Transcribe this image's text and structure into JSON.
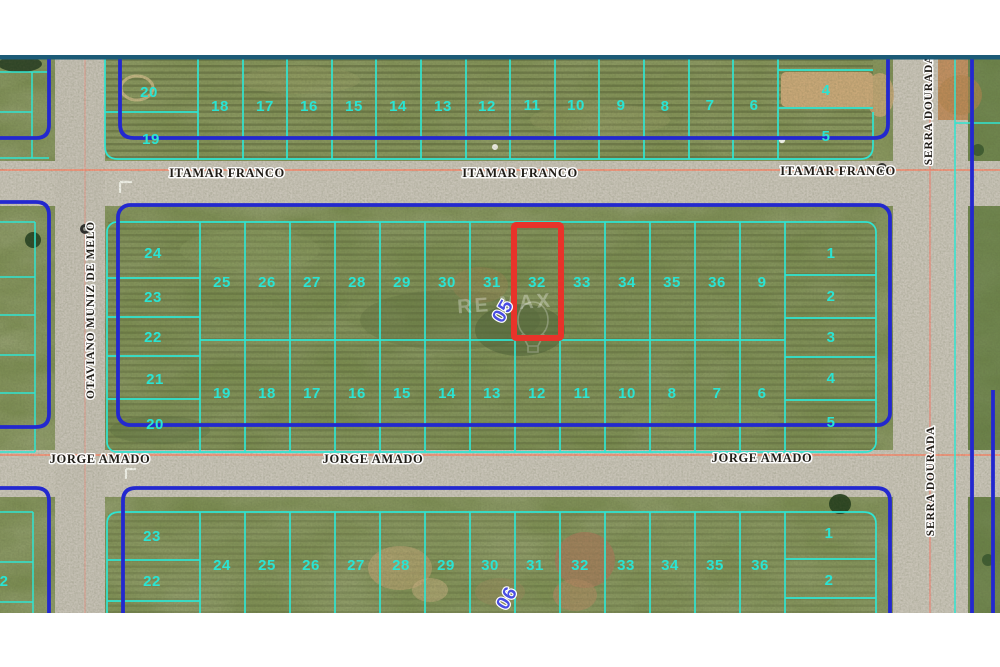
{
  "map": {
    "title": "Aerial lot map with highlighted lot 32",
    "streets": {
      "itamar_franco": {
        "name": "ITAMAR FRANCO"
      },
      "jorge_amado": {
        "name": "JORGE AMADO"
      },
      "serra_dourada": {
        "name": "SERRA DOURADA"
      },
      "otaviano_muniz_de_melo": {
        "name": "OTAVIANO MUNIZ DE MELO"
      }
    },
    "blocks": {
      "top": {
        "left_col": [
          "20",
          "19"
        ],
        "row": [
          "18",
          "17",
          "16",
          "15",
          "14",
          "13",
          "12",
          "11",
          "10",
          "9",
          "8",
          "7",
          "6"
        ],
        "right_col": [
          "4",
          "5"
        ]
      },
      "middle": {
        "block_number": "05",
        "left_col": [
          "24",
          "23",
          "22",
          "21",
          "20"
        ],
        "top_row": [
          "25",
          "26",
          "27",
          "28",
          "29",
          "30",
          "31",
          "32",
          "33",
          "34",
          "35",
          "36",
          "9"
        ],
        "bottom_row": [
          "19",
          "18",
          "17",
          "16",
          "15",
          "14",
          "13",
          "12",
          "11",
          "10",
          "8",
          "7",
          "6"
        ],
        "right_col": [
          "1",
          "2",
          "3",
          "4",
          "5"
        ],
        "highlighted_lot": "32"
      },
      "bottom": {
        "block_number": "06",
        "left_col": [
          "23",
          "22"
        ],
        "row": [
          "24",
          "25",
          "26",
          "27",
          "28",
          "29",
          "30",
          "31",
          "32",
          "33",
          "34",
          "35",
          "36"
        ],
        "right_col": [
          "1",
          "2"
        ],
        "edge_lot": "2"
      }
    },
    "watermark": "RE MAX",
    "colors": {
      "lot_line_cyan": "#2fe5d2",
      "block_border_blue": "#2328cf",
      "highlight_red": "#e8332a",
      "road_guide_pink": "#ef977f",
      "photo_edge_teal": "#1c5b77",
      "grass_base": "#78894e",
      "road_surface": "#c9c4b8"
    }
  }
}
